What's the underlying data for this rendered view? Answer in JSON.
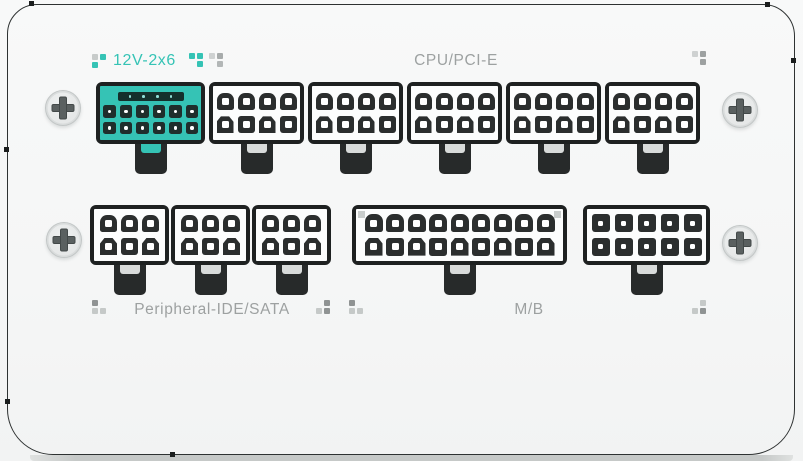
{
  "colors": {
    "teal": "#35c3b5",
    "label_gray": "#9da1a1",
    "outline": "#2e3232",
    "connector_border": "#1e2121",
    "connector_face": "#fcfdfd",
    "pin_dark": "#2b2e2e",
    "pin_hole": "#ffffff",
    "tab_black": "#272a2a",
    "tab_tongue": "#d8dbda",
    "bottom_strip": "#c6c9c8",
    "screw_face": "#eef0f0",
    "screw_ring": "#c2c6c6",
    "screw_cross": "#5a6060"
  },
  "labels": {
    "v12": "12V-2x6",
    "cpu_pcie": "CPU/PCI-E",
    "peripheral": "Peripheral-IDE/SATA",
    "mb": "M/B"
  },
  "icons": {
    "screw": "phillips-cross-screw",
    "pixel_cluster": "decorative-pixel-dots"
  },
  "connectors": {
    "v12_2x6": {
      "style": "teal",
      "rows": 2,
      "cols": 6,
      "sense_pins": 4,
      "count": 1,
      "label": "12V-2x6"
    },
    "cpu_pcie_group": {
      "style": "black8",
      "rows": 2,
      "cols": 4,
      "count": 5,
      "label": "CPU/PCI-E"
    },
    "peripheral_group": {
      "style": "black6",
      "rows": 2,
      "cols": 3,
      "count": 3,
      "label": "Peripheral-IDE/SATA"
    },
    "mb_18pin": {
      "style": "black18",
      "rows": 2,
      "cols": 9,
      "count": 1,
      "label": "M/B"
    },
    "aux_10pin": {
      "style": "black10",
      "rows": 2,
      "cols": 5,
      "count": 1,
      "label": ""
    }
  },
  "clusters": {
    "lead_12v": [
      [
        "#c7cbca",
        "#35c3b5"
      ],
      [
        "#35c3b5",
        null
      ]
    ],
    "trail_12v_a": [
      [
        "#35c3b5",
        "#35c3b5"
      ],
      [
        null,
        "#35c3b5"
      ]
    ],
    "trail_12v_b": [
      [
        "#ced1d1",
        "#a7abab"
      ],
      [
        null,
        "#b3b7b7"
      ]
    ],
    "top_right": [
      [
        "#ced1d1",
        "#9da1a1"
      ],
      [
        null,
        "#9da1a1"
      ]
    ],
    "peripheral_left": [
      [
        "#8f9393",
        null
      ],
      [
        "#c5c9c8",
        "#c5c9c8"
      ]
    ],
    "peripheral_right": [
      [
        null,
        "#8f9393"
      ],
      [
        "#c5c9c8",
        "#8f9393"
      ]
    ],
    "mb_left": [
      [
        "#8f9393",
        null
      ],
      [
        "#c5c9c8",
        "#c5c9c8"
      ]
    ],
    "bottom_right": [
      [
        null,
        "#c5c9c8"
      ],
      [
        "#c5c9c8",
        "#8f9393"
      ]
    ]
  },
  "screw_count": 4
}
